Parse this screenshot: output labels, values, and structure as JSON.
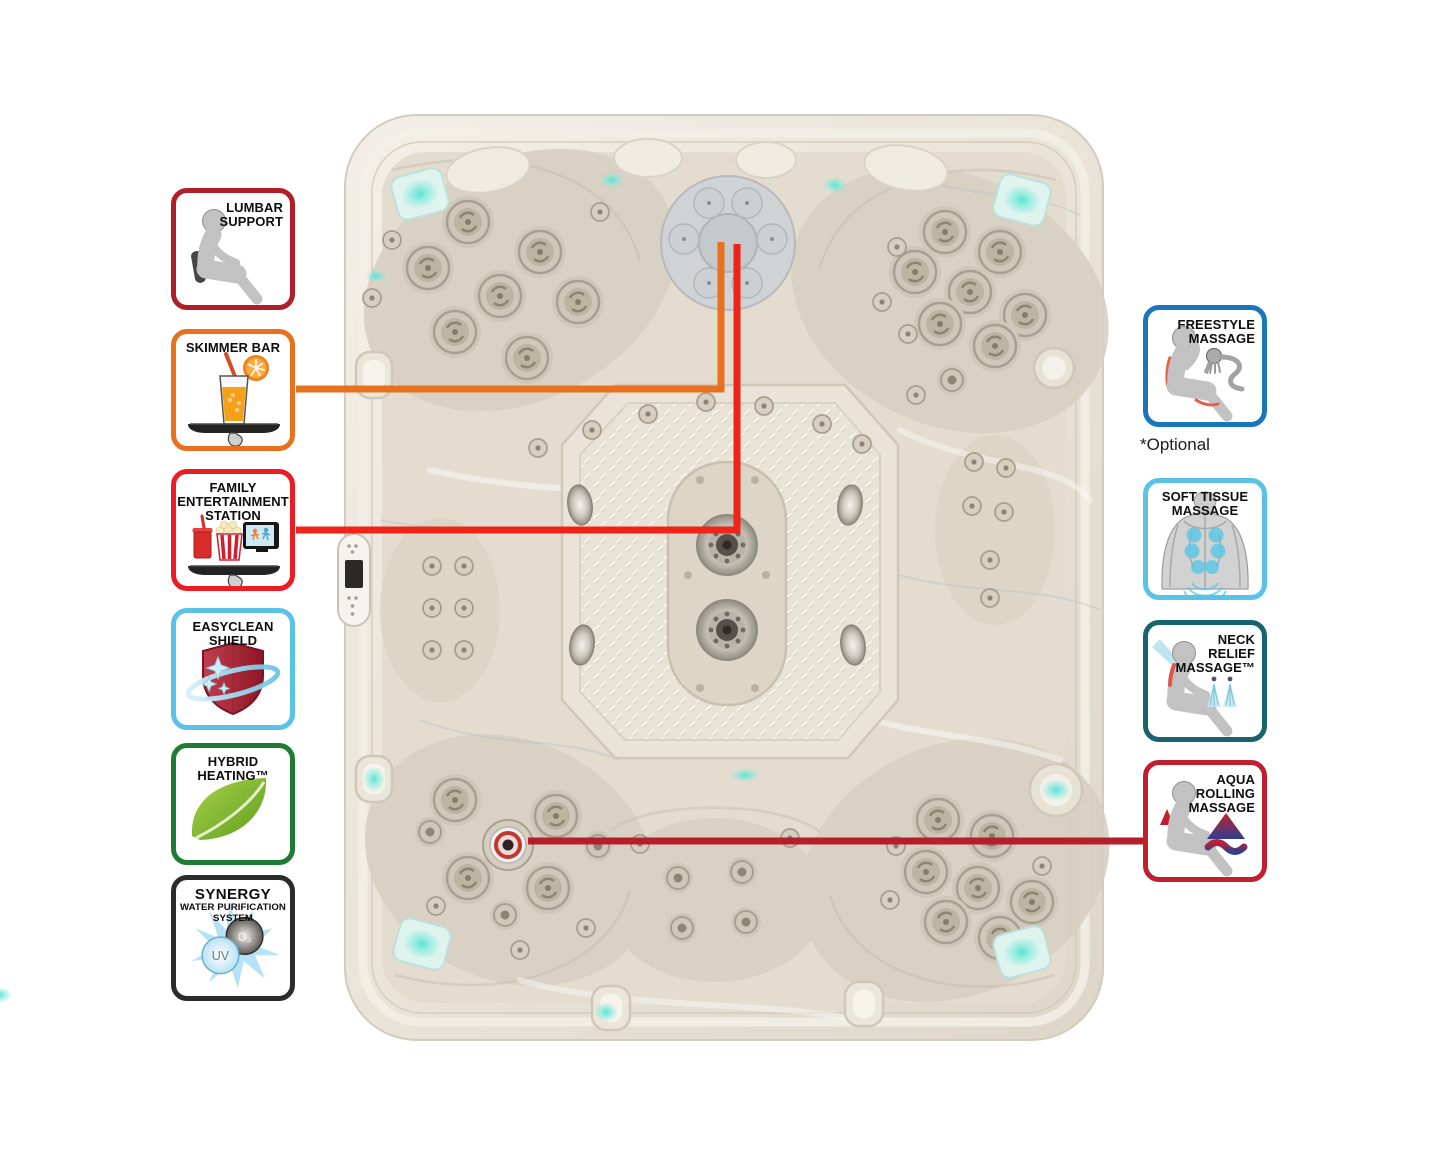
{
  "optional_note": "*Optional",
  "badges": {
    "left": [
      {
        "name": "lumbar-support",
        "label_lines": [
          "LUMBAR",
          "SUPPORT"
        ],
        "border": "#B01E28",
        "icon": "person-lumbar-icon"
      },
      {
        "name": "skimmer-bar",
        "label_lines": [
          "SKIMMER BAR"
        ],
        "border": "#E8711F",
        "icon": "drink-tray-icon"
      },
      {
        "name": "family-entertainment-station",
        "label_lines": [
          "FAMILY",
          "ENTERTAINMENT",
          "STATION"
        ],
        "border": "#EC1C24",
        "icon": "entertainment-tray-icon"
      },
      {
        "name": "easyclean-shield",
        "label_lines": [
          "EASYCLEAN",
          "SHIELD"
        ],
        "border": "#5BC2E7",
        "icon": "shield-icon"
      },
      {
        "name": "hybrid-heating",
        "label_lines": [
          "HYBRID",
          "HEATING™"
        ],
        "border": "#1F7A33",
        "icon": "leaf-icon"
      },
      {
        "name": "synergy-water-purification-system",
        "label_lines": [
          "SYNERGY",
          "WATER PURIFICATION",
          "SYSTEM"
        ],
        "border": "#2B2B2B",
        "icon": "water-purification-icon",
        "uv_label": "UV",
        "o3_label": "O₃"
      }
    ],
    "right": [
      {
        "name": "freestyle-massage",
        "label_lines": [
          "FREESTYLE",
          "MASSAGE"
        ],
        "border": "#1B75BC",
        "icon": "freestyle-massage-icon"
      },
      {
        "name": "soft-tissue-massage",
        "label_lines": [
          "SOFT TISSUE",
          "MASSAGE"
        ],
        "border": "#5BC2E7",
        "icon": "soft-tissue-icon"
      },
      {
        "name": "neck-relief-massage",
        "label_lines": [
          "NECK",
          "RELIEF",
          "MASSAGE™"
        ],
        "border": "#17646E",
        "icon": "neck-relief-icon"
      },
      {
        "name": "aqua-rolling-massage",
        "label_lines": [
          "AQUA",
          "ROLLING",
          "MASSAGE"
        ],
        "border": "#C01F2F",
        "icon": "aqua-rolling-icon"
      }
    ]
  },
  "connectors": [
    {
      "name": "skimmer-bar-connector",
      "color": "#E8711F"
    },
    {
      "name": "entertainment-connector",
      "color": "#EE2418"
    },
    {
      "name": "aqua-rolling-connector",
      "color": "#B51F2C"
    }
  ],
  "tub": {
    "shell_color": "#E9E3D8",
    "accent_light_color": "#4FE3D2",
    "jet_metal_color": "#C9C2B4"
  }
}
